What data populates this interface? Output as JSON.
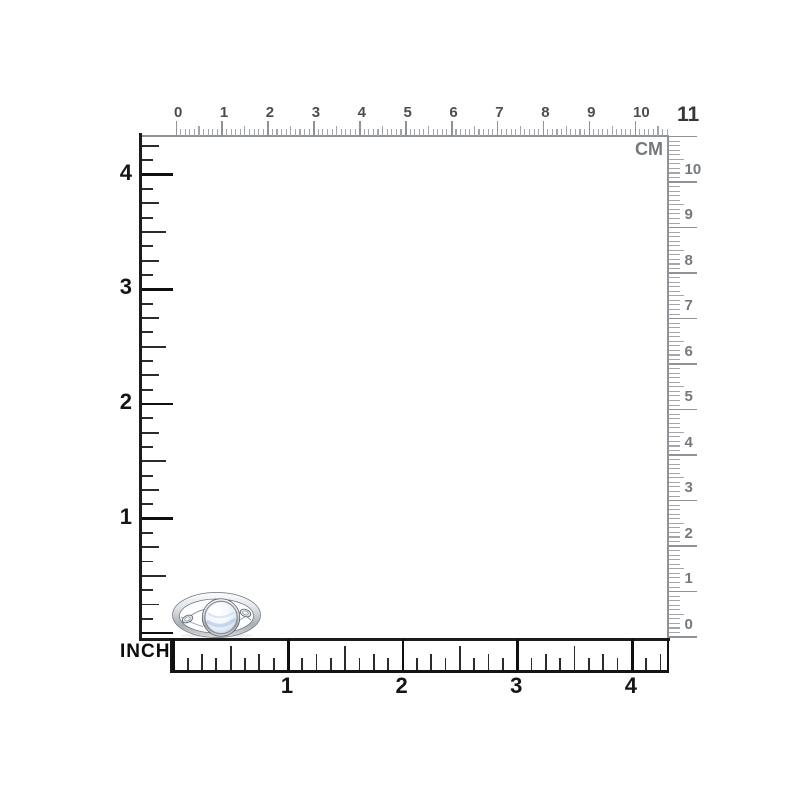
{
  "image_subject": "Silver celtic-knot ring with round white-blue moonstone shown to scale against centimeter and inch rulers",
  "rulers": {
    "cm_unit_label": "CM",
    "cm_corner_label": "11",
    "inch_unit_label": "INCH",
    "top": {
      "numbers": [
        "0",
        "1",
        "2",
        "3",
        "4",
        "5",
        "6",
        "7",
        "8",
        "9",
        "10"
      ]
    },
    "right": {
      "numbers": [
        "10",
        "9",
        "8",
        "7",
        "6",
        "5",
        "4",
        "3",
        "2",
        "1",
        "0"
      ]
    },
    "left": {
      "numbers": [
        "4",
        "3",
        "2",
        "1"
      ]
    },
    "bottom": {
      "numbers": [
        "1",
        "2",
        "3",
        "4"
      ]
    }
  },
  "colors": {
    "background": "#ffffff",
    "cm_line": "#8f9397",
    "cm_tick": "#a3a7ab",
    "cm_tick_major": "#8f9397",
    "cm_number": "#4a4e52",
    "cm_number_right": "#75797d",
    "inch_line": "#1c1c1c",
    "inch_tick": "#2b2b2b",
    "inch_tick_major": "#0f0f0f",
    "inch_number": "#161616",
    "ring_metal": "#c7ccd1",
    "moonstone": "#dce6f4"
  }
}
